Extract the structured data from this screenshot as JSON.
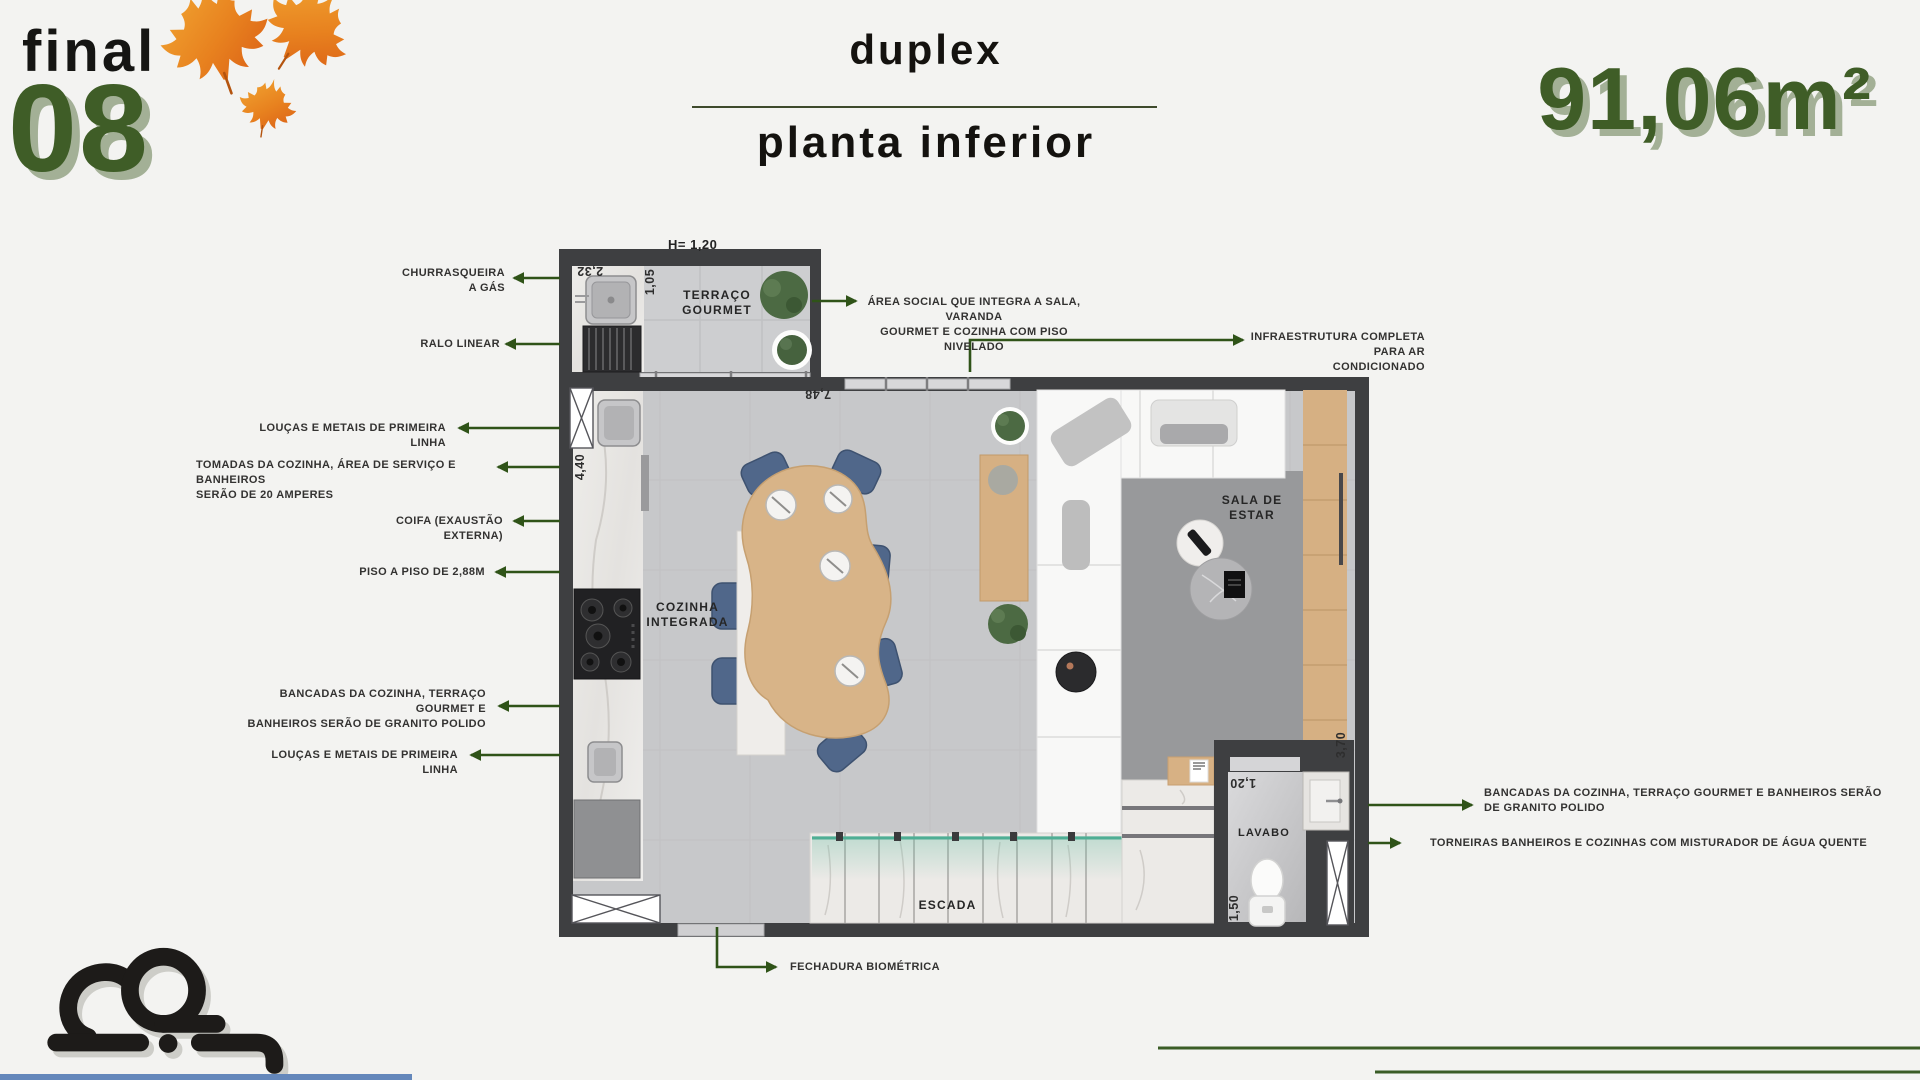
{
  "header": {
    "unit_label": "final",
    "unit_number": "08",
    "title": "duplex",
    "subtitle": "planta inferior",
    "area": "91,06m²"
  },
  "plan": {
    "height_note": "H= 1,20",
    "rooms": {
      "terraco": "TERRAÇO\nGOURMET",
      "cozinha": "COZINHA\nINTEGRADA",
      "sala": "SALA DE\nESTAR",
      "escada": "ESCADA",
      "lavabo": "LAVABO"
    },
    "dims": {
      "d232": "2,32",
      "d105": "1,05",
      "d748": "7,48",
      "d440": "4,40",
      "d370": "3,70",
      "d120": "1,20",
      "d150": "1,50"
    }
  },
  "callouts": {
    "churrasqueira": "CHURRASQUEIRA\nA GÁS",
    "ralo": "RALO LINEAR",
    "loucas_top": "LOUÇAS E METAIS DE PRIMEIRA LINHA",
    "tomadas": "TOMADAS DA COZINHA, ÁREA DE SERVIÇO E BANHEIROS\nSERÃO DE 20 AMPERES",
    "coifa": "COIFA (EXAUSTÃO EXTERNA)",
    "piso": "PISO A  PISO DE 2,88M",
    "bancadas_left": "BANCADAS DA COZINHA, TERRAÇO GOURMET E\nBANHEIROS SERÃO DE GRANITO POLIDO",
    "loucas_bottom": "LOUÇAS E METAIS DE PRIMEIRA LINHA",
    "area_social": "ÁREA SOCIAL QUE INTEGRA A SALA, VARANDA\nGOURMET E COZINHA COM PISO NIVELADO",
    "infraestrutura": "INFRAESTRUTURA COMPLETA PARA AR\nCONDICIONADO",
    "bancadas_right": "BANCADAS DA COZINHA, TERRAÇO GOURMET E BANHEIROS SERÃO\nDE GRANITO POLIDO",
    "torneiras": "TORNEIRAS BANHEIROS E COZINHAS COM MISTURADOR DE ÁGUA QUENTE",
    "fechadura": "FECHADURA BIOMÉTRICA"
  },
  "colors": {
    "accent_green": "#3f5d27",
    "arrow_green": "#2f5318",
    "shadow_sage": "#a3b096",
    "leaf_orange": "#e8821f",
    "wall_dark": "#3e3f41",
    "floor_gray": "#c7c8ca",
    "wood_tan": "#d6b083",
    "chair_blue": "#50678a",
    "glass_teal": "#4fae94",
    "footer_blue": "#6487bb"
  }
}
